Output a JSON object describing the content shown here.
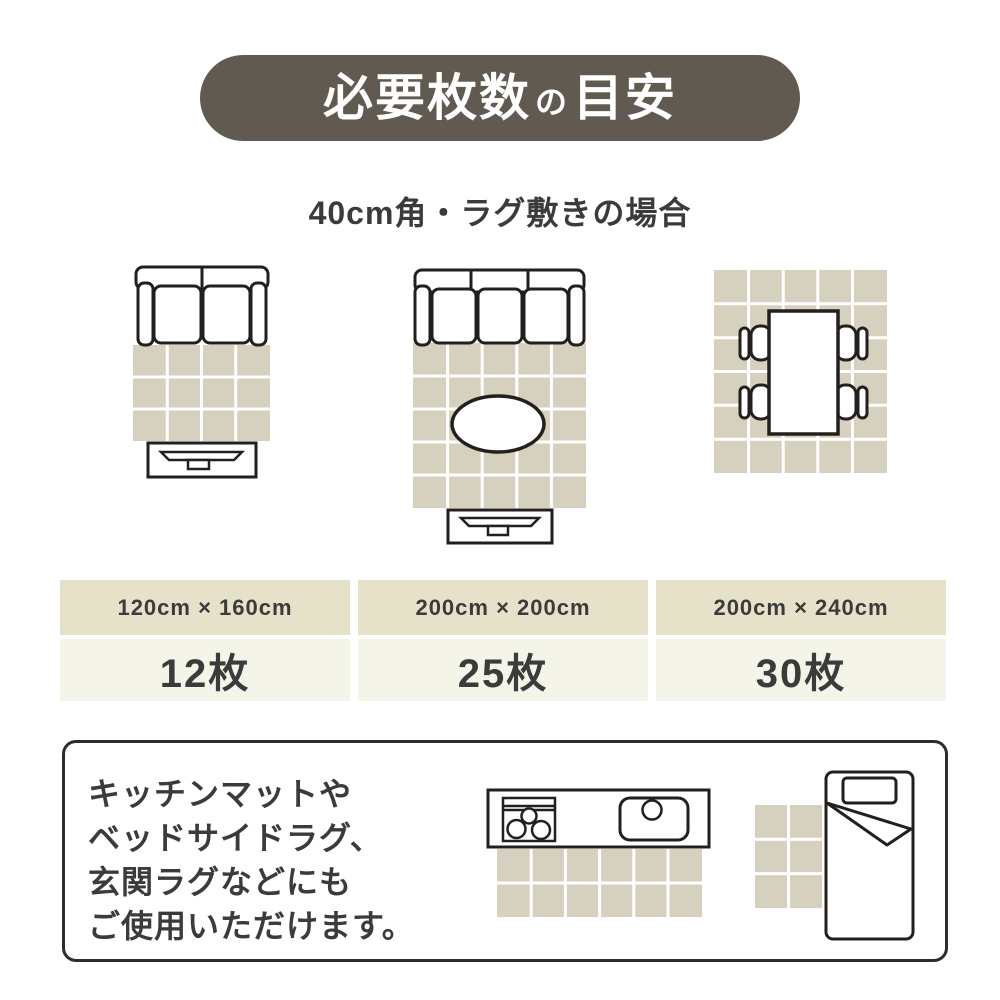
{
  "title": {
    "text": "必要枚数の目安",
    "segments": {
      "a": "必要枚数",
      "b": "の",
      "c": "目安"
    }
  },
  "subtitle": "40cm角・ラグ敷きの場合",
  "layouts": [
    {
      "name": "two-seat-sofa-rug",
      "label": "120cm × 160cm",
      "count": "12枚",
      "tiles_wide": 4,
      "tiles_tall": 3,
      "total_tiles": 12,
      "furniture": [
        "2-seat sofa",
        "tv-board"
      ]
    },
    {
      "name": "three-seat-sofa-rug",
      "label": "200cm × 200cm",
      "count": "25枚",
      "tiles_wide": 5,
      "tiles_tall": 5,
      "total_tiles": 25,
      "furniture": [
        "3-seat sofa",
        "oval table",
        "tv-board"
      ]
    },
    {
      "name": "dining-table-rug",
      "label": "200cm × 240cm",
      "count": "30枚",
      "tiles_wide": 5,
      "tiles_tall": 6,
      "total_tiles": 30,
      "furniture": [
        "dining table",
        "4 chairs"
      ]
    }
  ],
  "note": {
    "lines": [
      "キッチンマットや",
      "ベッドサイドラグ、",
      "玄関ラグなどにも",
      "ご使用いただけます。"
    ]
  },
  "bottom_illustrations": {
    "kitchen_mat": {
      "tiles_wide": 6,
      "tiles_tall": 2
    },
    "bedside_mat": {
      "tiles_wide": 2,
      "tiles_tall": 3
    }
  },
  "colors": {
    "brand": "#615a50",
    "title_text": "#ffffff",
    "tile": "#d6d0be",
    "grid_line": "#ffffff",
    "table_header_bg": "#e6e2ca",
    "table_value_bg": "#f5f4e8",
    "text": "#3b3b3b",
    "line_art": "#221f1c"
  }
}
